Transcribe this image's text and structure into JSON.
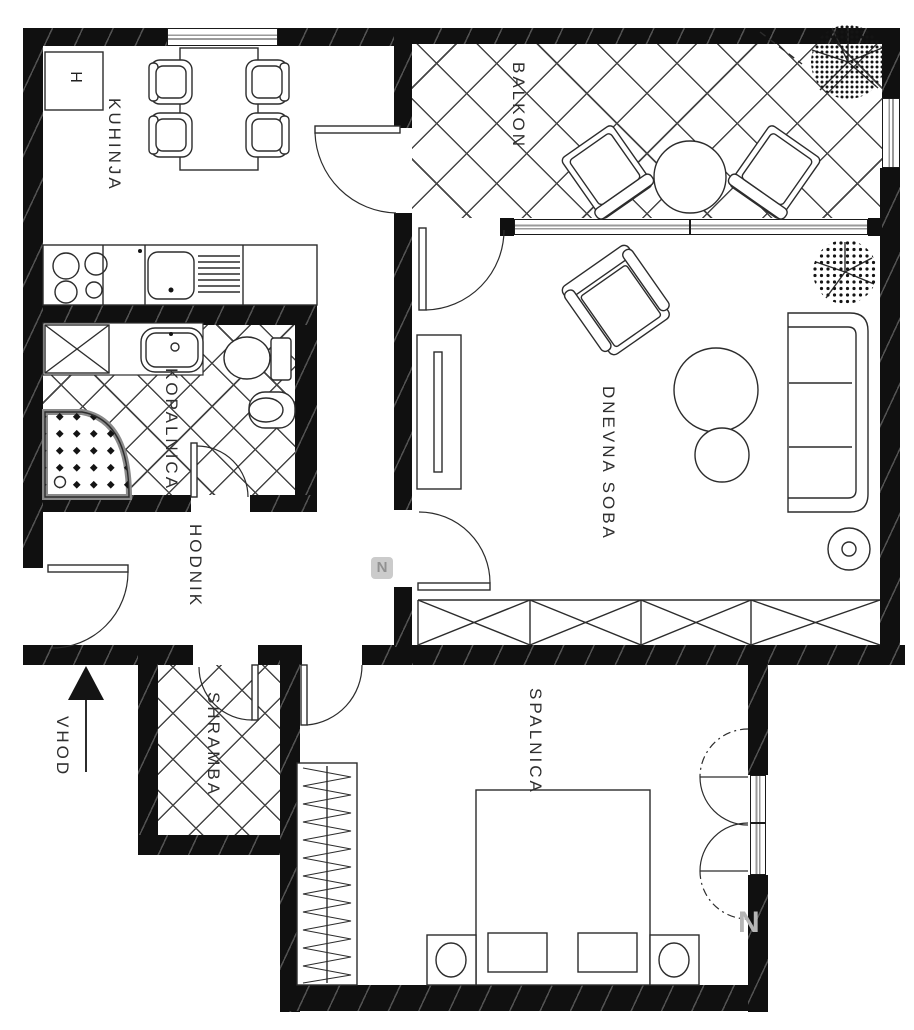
{
  "title": "Apartment floor plan",
  "rooms": {
    "kitchen": {
      "label": "KUHINJA"
    },
    "balcony": {
      "label": "BALKON"
    },
    "bathroom": {
      "label": "KOPALNICA"
    },
    "hallway": {
      "label": "HODNIK"
    },
    "living_room": {
      "label": "DNEVNA SOBA"
    },
    "storage": {
      "label": "SHRAMBA"
    },
    "bedroom": {
      "label": "SPALNICA"
    }
  },
  "entrance": {
    "label": "VHOD"
  },
  "appliances": {
    "fridge_label": "H"
  },
  "watermark": {
    "badge": "N",
    "corner": "N"
  },
  "colors": {
    "wall": "#101010",
    "line": "#2e2e2e",
    "window_line": "#9a9a9a"
  }
}
